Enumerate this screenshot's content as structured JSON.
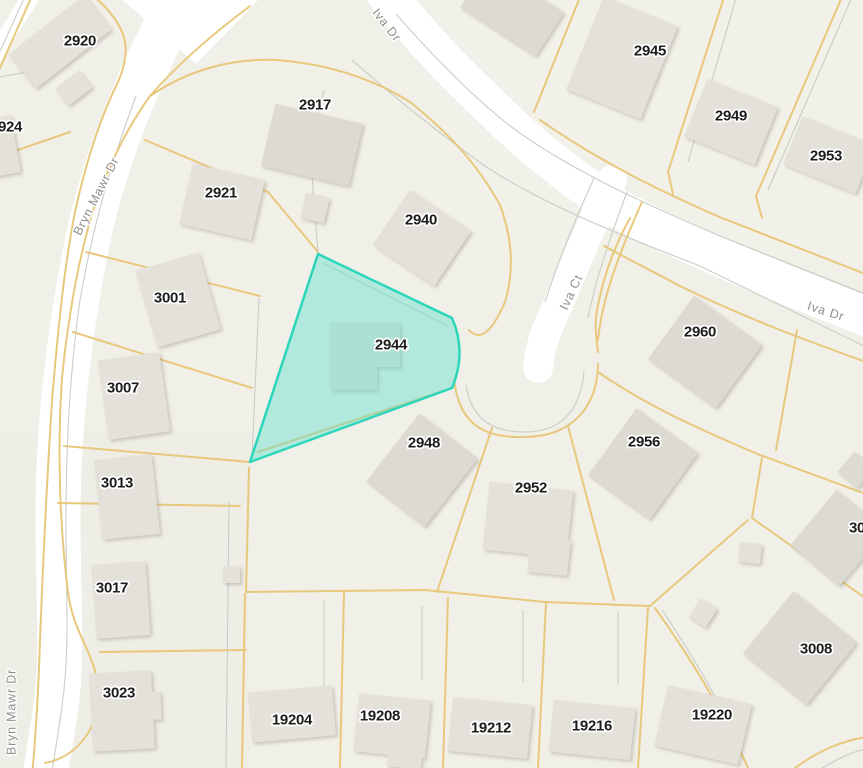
{
  "map": {
    "background_color": "#f0efe8",
    "road_color": "#ffffff",
    "parcel_line_color": "#e8c87c",
    "boundary_line_color": "#c6cac4",
    "building_color": "#e3e1da",
    "highlight": {
      "parcel": "2944",
      "fill_color": "#5ee0cd",
      "fill_opacity": 0.42,
      "border_color": "#2cd6bb"
    },
    "street_labels": [
      {
        "id": "iva-dr-top",
        "text": "Iva Dr",
        "x": 387,
        "y": 25,
        "rotate": 52
      },
      {
        "id": "iva-dr-right",
        "text": "Iva Dr",
        "x": 826,
        "y": 311,
        "rotate": 18
      },
      {
        "id": "iva-ct",
        "text": "Iva Ct",
        "x": 571,
        "y": 292,
        "rotate": -65
      },
      {
        "id": "bryn-mawr-upper",
        "text": "Bryn Mawr Dr",
        "x": 96,
        "y": 196,
        "rotate": -63
      },
      {
        "id": "bryn-mawr-lower",
        "text": "Bryn Mawr Dr",
        "x": 11,
        "y": 712,
        "rotate": -90
      }
    ],
    "parcel_labels": [
      {
        "text": "2920",
        "x": 80,
        "y": 40
      },
      {
        "text": "924",
        "x": 10,
        "y": 126
      },
      {
        "text": "2917",
        "x": 315,
        "y": 104
      },
      {
        "text": "2921",
        "x": 221,
        "y": 192
      },
      {
        "text": "2940",
        "x": 421,
        "y": 219
      },
      {
        "text": "2945",
        "x": 650,
        "y": 50
      },
      {
        "text": "2949",
        "x": 731,
        "y": 115
      },
      {
        "text": "2953",
        "x": 826,
        "y": 155
      },
      {
        "text": "2944",
        "x": 391,
        "y": 344
      },
      {
        "text": "2960",
        "x": 700,
        "y": 331
      },
      {
        "text": "2948",
        "x": 424,
        "y": 442
      },
      {
        "text": "2952",
        "x": 531,
        "y": 487
      },
      {
        "text": "2956",
        "x": 644,
        "y": 441
      },
      {
        "text": "3001",
        "x": 170,
        "y": 297
      },
      {
        "text": "3007",
        "x": 123,
        "y": 387
      },
      {
        "text": "3013",
        "x": 117,
        "y": 482
      },
      {
        "text": "3017",
        "x": 112,
        "y": 587
      },
      {
        "text": "3023",
        "x": 119,
        "y": 692
      },
      {
        "text": "3008",
        "x": 816,
        "y": 648
      },
      {
        "text": "30",
        "x": 857,
        "y": 527
      },
      {
        "text": "19204",
        "x": 292,
        "y": 719
      },
      {
        "text": "19208",
        "x": 380,
        "y": 715
      },
      {
        "text": "19212",
        "x": 491,
        "y": 727
      },
      {
        "text": "19216",
        "x": 592,
        "y": 725
      },
      {
        "text": "19220",
        "x": 712,
        "y": 714
      }
    ]
  }
}
